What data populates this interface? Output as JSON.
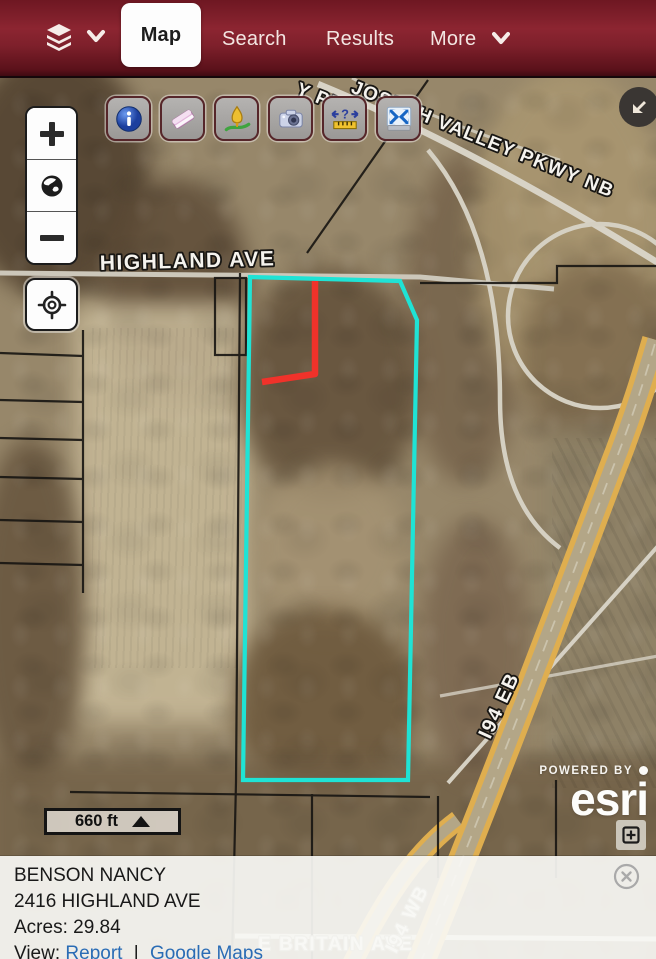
{
  "header": {
    "layers_menu": {
      "icon": "layers-icon",
      "chevron_icon": "chevron-down-icon"
    },
    "tabs": [
      {
        "label": "Map",
        "active": true
      },
      {
        "label": "Search",
        "active": false
      },
      {
        "label": "Results",
        "active": false
      },
      {
        "label": "More",
        "active": false,
        "has_chevron": true
      }
    ]
  },
  "toolbar": {
    "buttons": [
      {
        "icon": "info-icon"
      },
      {
        "icon": "eraser-icon"
      },
      {
        "icon": "draw-icon"
      },
      {
        "icon": "camera-icon"
      },
      {
        "icon": "measure-icon",
        "glyph": "?"
      },
      {
        "icon": "zoom-extent-icon"
      }
    ]
  },
  "map_controls": {
    "zoom_in": "plus-icon",
    "home": "globe-icon",
    "zoom_out": "minus-icon",
    "locate": "crosshair-icon",
    "collapse": "arrow-down-left-icon",
    "expand": "plus-box-icon"
  },
  "map": {
    "labels": {
      "highland_ave": "HIGHLAND AVE",
      "joseph_valley_pkwy": "JOSEPH VALLEY PKWY NB",
      "pkwy_partial": "Y PKW",
      "i94_eb": "I94 EB",
      "e_britain_ave": "E BRITAIN AVE",
      "i94_wb": "I94 WB"
    },
    "scale_text": "660 ft",
    "attribution": {
      "powered_by": "POWERED BY",
      "brand": "esri"
    },
    "colors": {
      "parcel_highlight": "#1fe3d5",
      "drawn_line": "#f0322a",
      "link": "#2a6cb5",
      "header": "#7e202b"
    }
  },
  "panel": {
    "owner": "BENSON NANCY",
    "address": "2416 HIGHLAND AVE",
    "acres_label": "Acres:",
    "acres_value": "29.84",
    "view_label": "View:",
    "report_link": "Report",
    "separator": "|",
    "maps_link": "Google Maps"
  }
}
